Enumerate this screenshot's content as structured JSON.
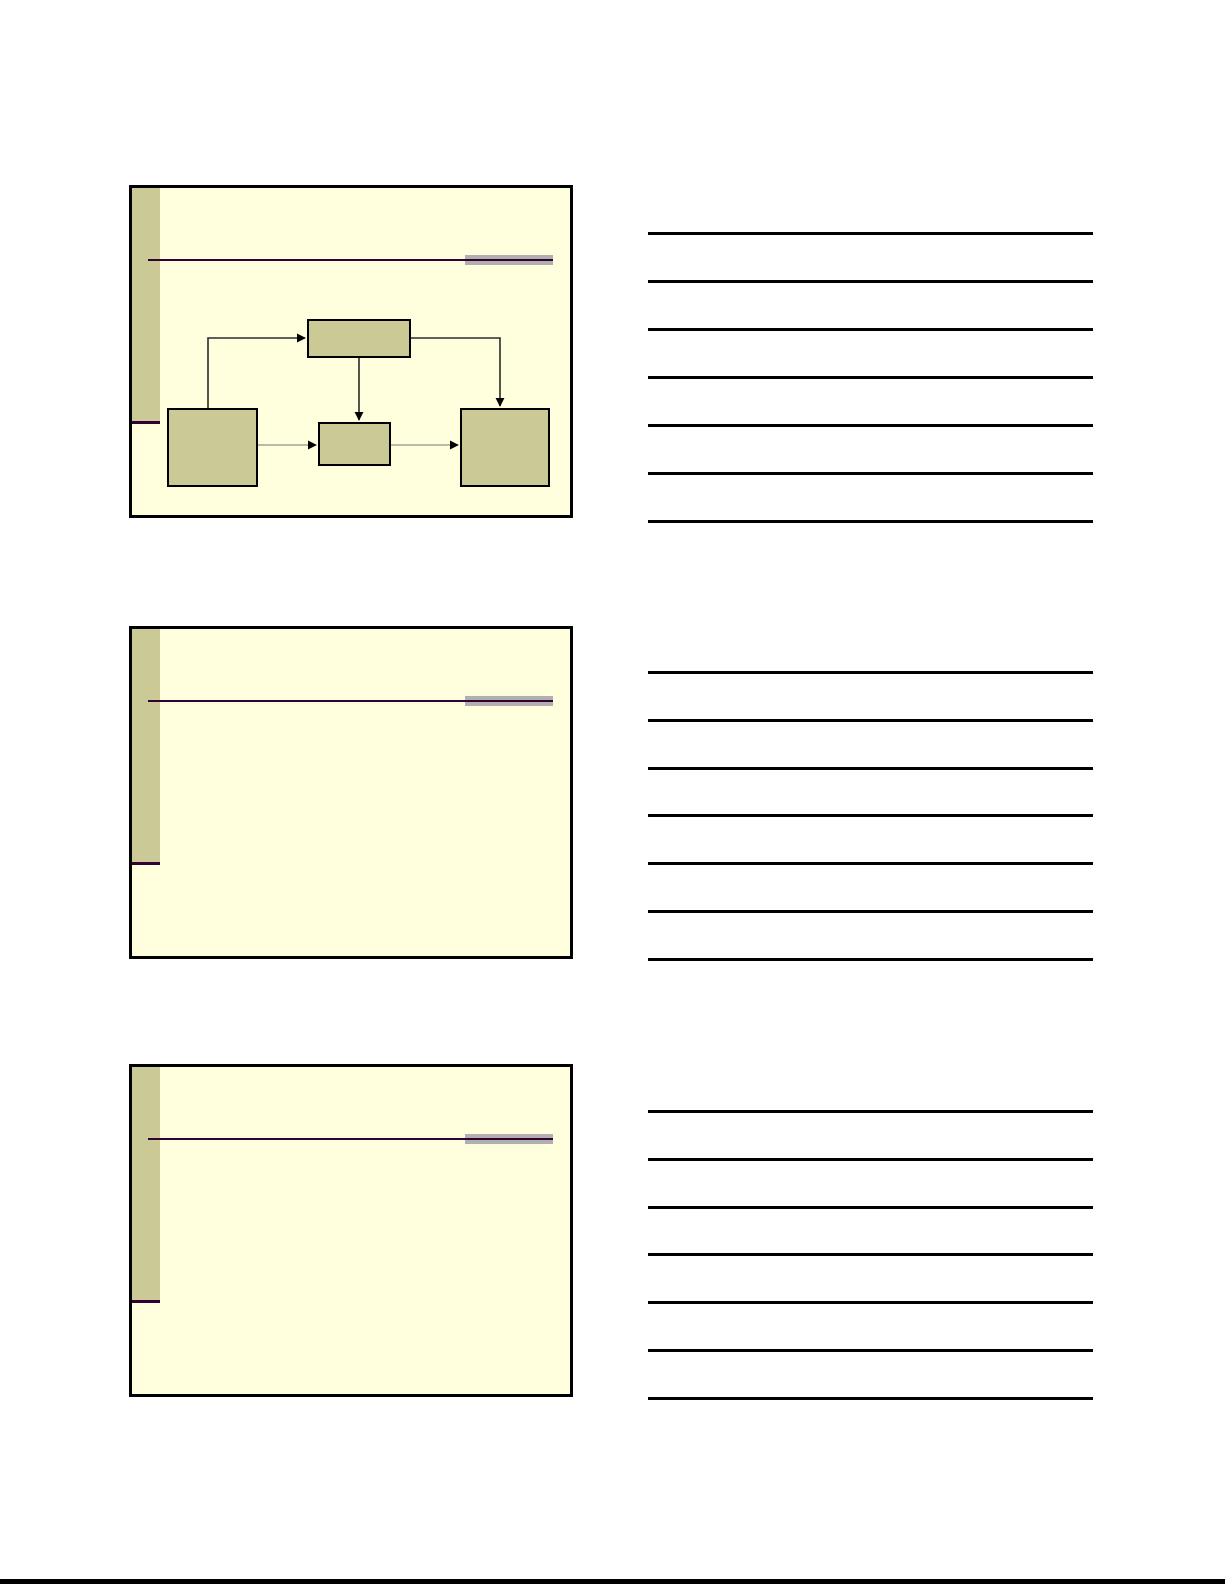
{
  "document": {
    "kind": "slide-handout-page",
    "slide_count": 3,
    "note_lines_per_slide": 7,
    "visible_text": ""
  },
  "colors": {
    "page-bg": "#ffffff",
    "slide-bg": "#ffffde",
    "slide-border": "#000000",
    "accent-olive": "#cbc996",
    "accent-purple": "#330033",
    "gray-bar": "#b0b0b0",
    "note-line": "#000000",
    "connector-dark": "#2b2b2b",
    "connector-gray": "#a3a396"
  },
  "slides": [
    {
      "index": 1,
      "content": "flow-diagram"
    },
    {
      "index": 2,
      "content": "empty"
    },
    {
      "index": 3,
      "content": "empty"
    }
  ],
  "diagram": {
    "type": "flowchart",
    "nodes": [
      {
        "id": "top-box",
        "label": ""
      },
      {
        "id": "left-box",
        "label": ""
      },
      {
        "id": "middle-box",
        "label": ""
      },
      {
        "id": "right-box",
        "label": ""
      }
    ],
    "edges": [
      {
        "from": "left-box",
        "to": "top-box",
        "style": "dark"
      },
      {
        "from": "top-box",
        "to": "middle-box",
        "style": "dark"
      },
      {
        "from": "top-box",
        "to": "right-box",
        "style": "dark"
      },
      {
        "from": "left-box",
        "to": "middle-box",
        "style": "gray"
      },
      {
        "from": "middle-box",
        "to": "right-box",
        "style": "gray"
      }
    ]
  }
}
